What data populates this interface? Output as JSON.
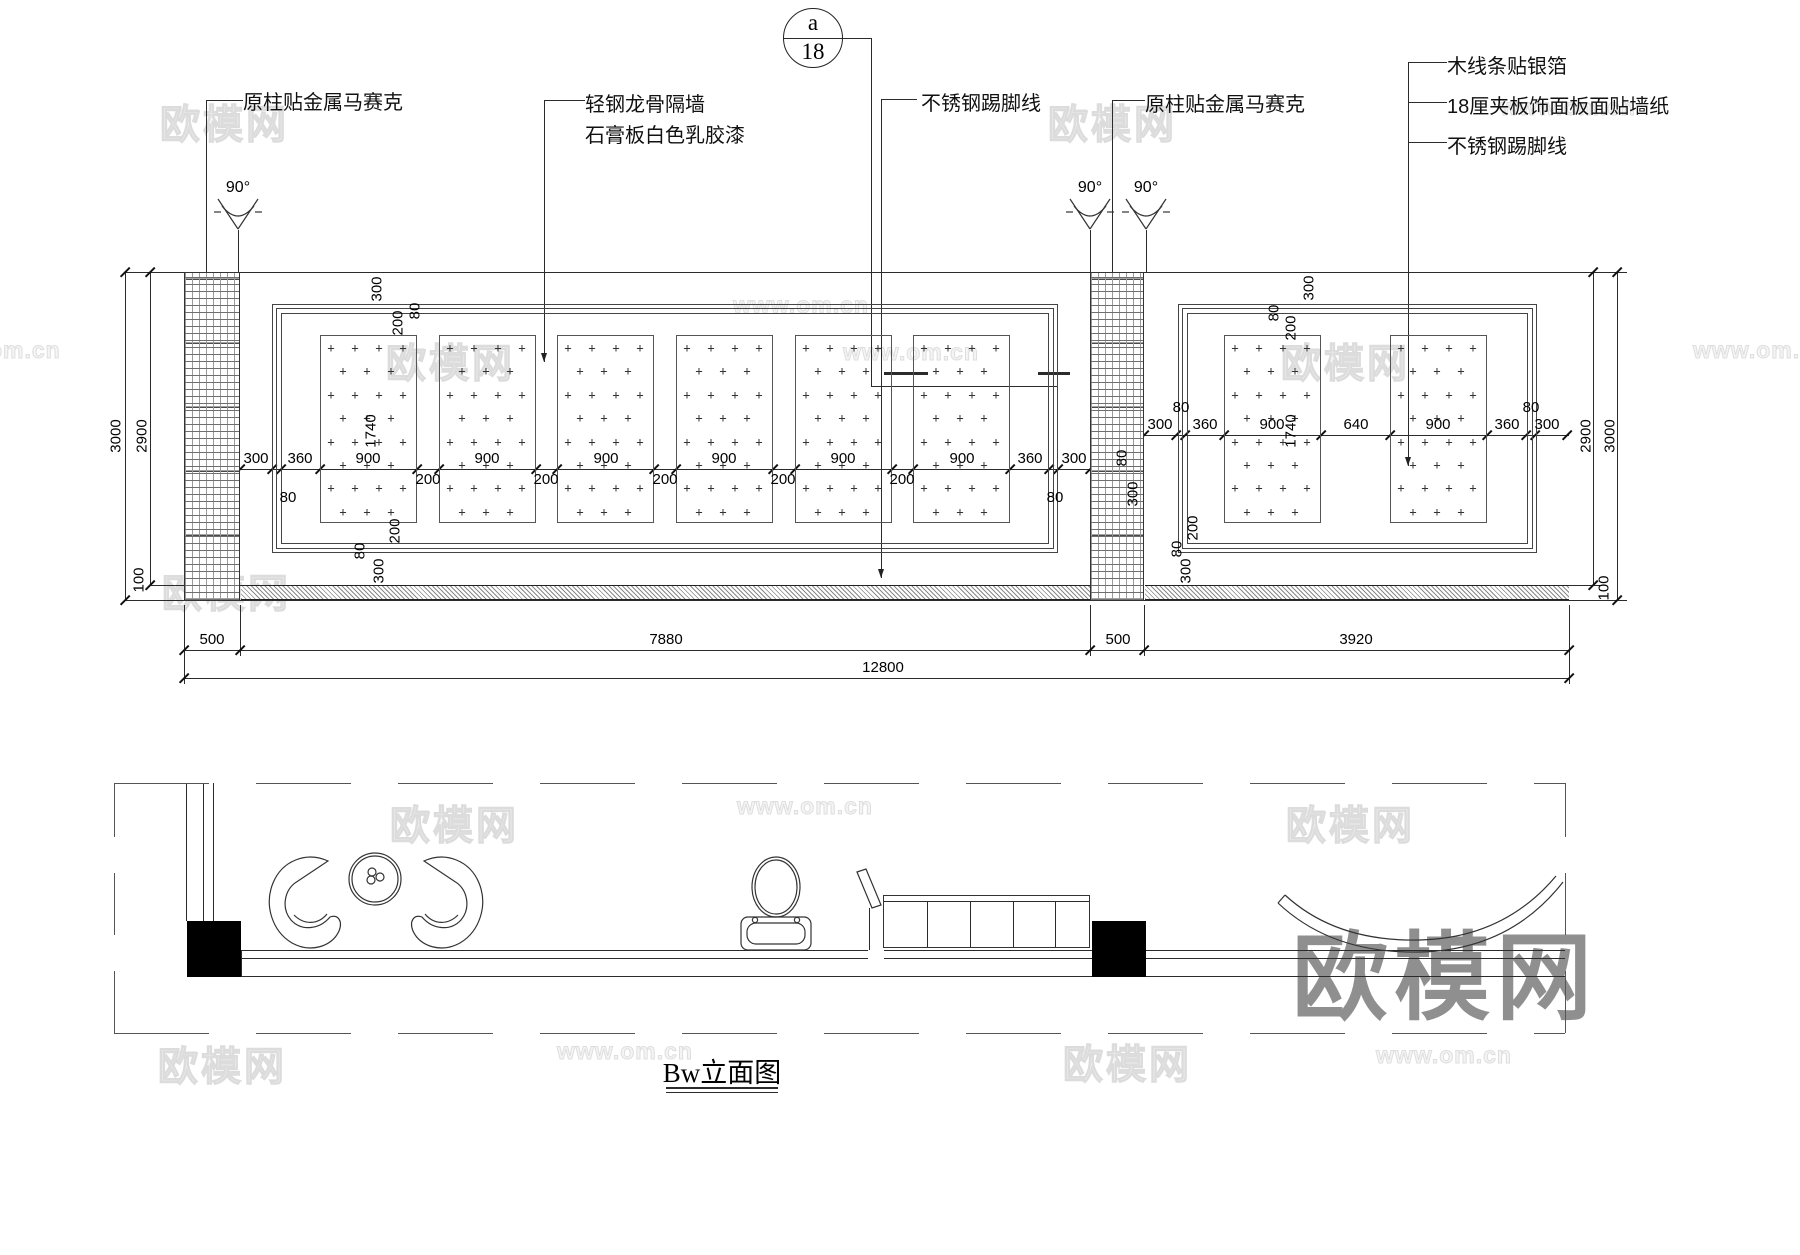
{
  "drawing_title": "Bw立面图",
  "section_marker": {
    "letter": "a",
    "number": "18"
  },
  "callouts": [
    {
      "id": "column-mosaic-left",
      "text": "原柱贴金属马赛克",
      "x": 243,
      "y": 86
    },
    {
      "id": "partition-line1",
      "text": "轻钢龙骨隔墙",
      "x": 585,
      "y": 88
    },
    {
      "id": "partition-line2",
      "text": "石膏板白色乳胶漆",
      "x": 585,
      "y": 119
    },
    {
      "id": "skirting-left",
      "text": "不锈钢踢脚线",
      "x": 921,
      "y": 87
    },
    {
      "id": "column-mosaic-right",
      "text": "原柱贴金属马赛克",
      "x": 1145,
      "y": 88
    },
    {
      "id": "silver-foil-moulding",
      "text": "木线条贴银箔",
      "x": 1447,
      "y": 50
    },
    {
      "id": "plywood-wallpaper",
      "text": "18厘夹板饰面板面贴墙纸",
      "x": 1447,
      "y": 90
    },
    {
      "id": "skirting-right",
      "text": "不锈钢踢脚线",
      "x": 1447,
      "y": 130
    }
  ],
  "angles": [
    {
      "text": "90°",
      "x": 238,
      "y": 179
    },
    {
      "text": "90°",
      "x": 1090,
      "y": 179
    },
    {
      "text": "90°",
      "x": 1146,
      "y": 179
    }
  ],
  "dims_horizontal": [
    {
      "t": "300",
      "x": 256,
      "y": 450
    },
    {
      "t": "360",
      "x": 300,
      "y": 450
    },
    {
      "t": "900",
      "x": 368,
      "y": 450
    },
    {
      "t": "900",
      "x": 487,
      "y": 450
    },
    {
      "t": "900",
      "x": 606,
      "y": 450
    },
    {
      "t": "900",
      "x": 724,
      "y": 450
    },
    {
      "t": "900",
      "x": 843,
      "y": 450
    },
    {
      "t": "900",
      "x": 962,
      "y": 450
    },
    {
      "t": "360",
      "x": 1030,
      "y": 450
    },
    {
      "t": "300",
      "x": 1074,
      "y": 450
    },
    {
      "t": "200",
      "x": 428,
      "y": 471
    },
    {
      "t": "200",
      "x": 546,
      "y": 471
    },
    {
      "t": "200",
      "x": 665,
      "y": 471
    },
    {
      "t": "200",
      "x": 783,
      "y": 471
    },
    {
      "t": "200",
      "x": 902,
      "y": 471
    },
    {
      "t": "80",
      "x": 288,
      "y": 489
    },
    {
      "t": "80",
      "x": 1055,
      "y": 489
    },
    {
      "t": "300",
      "x": 1160,
      "y": 416
    },
    {
      "t": "360",
      "x": 1205,
      "y": 416
    },
    {
      "t": "900",
      "x": 1272,
      "y": 416
    },
    {
      "t": "640",
      "x": 1356,
      "y": 416
    },
    {
      "t": "900",
      "x": 1438,
      "y": 416
    },
    {
      "t": "360",
      "x": 1507,
      "y": 416
    },
    {
      "t": "300",
      "x": 1547,
      "y": 416
    },
    {
      "t": "80",
      "x": 1181,
      "y": 399
    },
    {
      "t": "80",
      "x": 1531,
      "y": 399
    },
    {
      "t": "500",
      "x": 212,
      "y": 631
    },
    {
      "t": "7880",
      "x": 666,
      "y": 631
    },
    {
      "t": "500",
      "x": 1118,
      "y": 631
    },
    {
      "t": "3920",
      "x": 1356,
      "y": 631
    },
    {
      "t": "12800",
      "x": 883,
      "y": 659
    }
  ],
  "dims_vertical": [
    {
      "t": "3000",
      "x": 116,
      "y": 436
    },
    {
      "t": "2900",
      "x": 142,
      "y": 436
    },
    {
      "t": "100",
      "x": 139,
      "y": 580
    },
    {
      "t": "2900",
      "x": 1586,
      "y": 436
    },
    {
      "t": "3000",
      "x": 1610,
      "y": 436
    },
    {
      "t": "100",
      "x": 1604,
      "y": 588
    },
    {
      "t": "1740",
      "x": 371,
      "y": 431
    },
    {
      "t": "1740",
      "x": 1291,
      "y": 431
    },
    {
      "t": "300",
      "x": 377,
      "y": 289
    },
    {
      "t": "80",
      "x": 415,
      "y": 311
    },
    {
      "t": "200",
      "x": 398,
      "y": 323
    },
    {
      "t": "200",
      "x": 395,
      "y": 531
    },
    {
      "t": "80",
      "x": 360,
      "y": 551
    },
    {
      "t": "300",
      "x": 379,
      "y": 571
    },
    {
      "t": "300",
      "x": 1309,
      "y": 288
    },
    {
      "t": "80",
      "x": 1274,
      "y": 313
    },
    {
      "t": "200",
      "x": 1291,
      "y": 328
    },
    {
      "t": "80",
      "x": 1122,
      "y": 458
    },
    {
      "t": "300",
      "x": 1133,
      "y": 494
    },
    {
      "t": "200",
      "x": 1193,
      "y": 528
    },
    {
      "t": "80",
      "x": 1177,
      "y": 549
    },
    {
      "t": "300",
      "x": 1186,
      "y": 571
    }
  ],
  "overall_dimensions": {
    "total_width": "12800",
    "left_bay": "7880",
    "right_bay": "3920",
    "column_width": "500",
    "wall_height": "3000",
    "wall_above_floor": "2900",
    "floor_skirting": "100",
    "panel_height": "1740"
  },
  "watermarks_small": [
    {
      "t": "欧模网",
      "x": 160,
      "y": 92,
      "k": "cn"
    },
    {
      "t": "欧模网",
      "x": 386,
      "y": 331,
      "k": "cn"
    },
    {
      "t": "欧模网",
      "x": 1048,
      "y": 92,
      "k": "cn"
    },
    {
      "t": "欧模网",
      "x": 1281,
      "y": 331,
      "k": "cn"
    },
    {
      "t": "欧模网",
      "x": 162,
      "y": 561,
      "k": "cn"
    },
    {
      "t": "欧模网",
      "x": 390,
      "y": 793,
      "k": "cn"
    },
    {
      "t": "欧模网",
      "x": 1286,
      "y": 793,
      "k": "cn"
    },
    {
      "t": "欧模网",
      "x": 158,
      "y": 1034,
      "k": "cn"
    },
    {
      "t": "欧模网",
      "x": 1063,
      "y": 1032,
      "k": "cn"
    },
    {
      "t": "www.om.cn",
      "x": 733,
      "y": 292,
      "k": "url"
    },
    {
      "t": "www.om.cn",
      "x": 843,
      "y": 339,
      "k": "url"
    },
    {
      "t": "www.om.cn",
      "x": 1693,
      "y": 337,
      "k": "url"
    },
    {
      "t": "www.om.cn",
      "x": 737,
      "y": 793,
      "k": "url"
    },
    {
      "t": "www.om.cn",
      "x": 557,
      "y": 1038,
      "k": "url"
    },
    {
      "t": "www.om.cn",
      "x": 1376,
      "y": 1042,
      "k": "url"
    },
    {
      "t": "www.om.cn",
      "x": 1500,
      "y": 94,
      "k": "url"
    },
    {
      "t": "om.cn",
      "x": -12,
      "y": 337,
      "k": "url"
    }
  ],
  "watermark_big": {
    "text": "欧模网",
    "x": 1292,
    "y": 900
  }
}
